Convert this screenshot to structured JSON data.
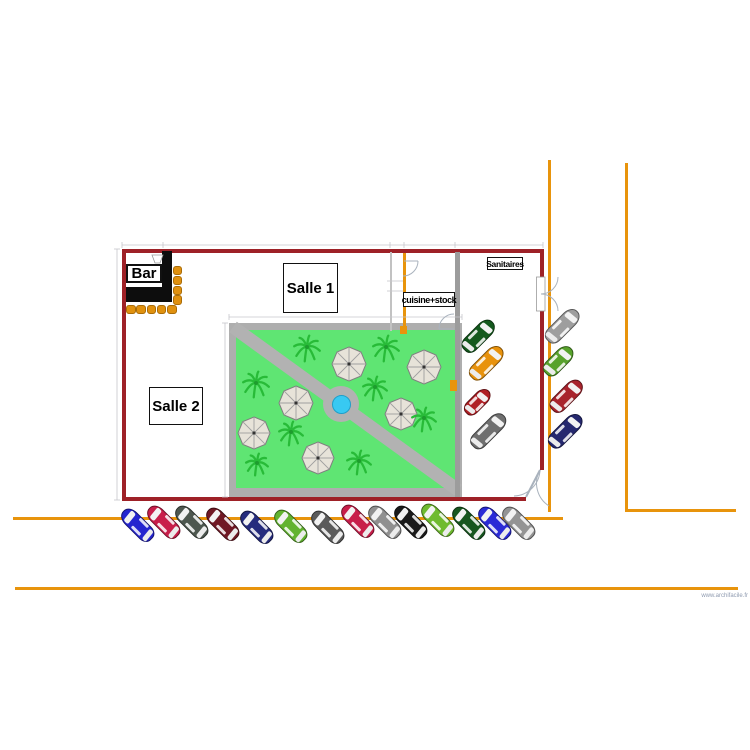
{
  "watermark": "www.archifacile.fr",
  "labels": {
    "bar": "Bar",
    "salle1": "Salle 1",
    "salle2": "Salle 2",
    "cuisine": "cuisine+stock",
    "sanitaires": "Sanitaires"
  },
  "colors": {
    "wall": "#9e2127",
    "interior_wall": "#9c9c9c",
    "thin_wall": "#c2c2c2",
    "bar": "#0d0d0d",
    "stool": "#e0910f",
    "stool_border": "#a96c08",
    "road": "#e8940c",
    "garden_frame": "#aeaeae",
    "grass": "#5fe573",
    "path": "#b2b2b2",
    "pool_rim": "#b2b2b2",
    "pool_water": "#38c9f2",
    "pool_water_edge": "#1f9fc9",
    "palm": "#28bb38",
    "palm_core": "#1e9c2e",
    "parasol": "#e7e3d9",
    "parasol_edge": "#7f7f7f",
    "parasol_line": "#9f9f9f",
    "door": "#a9b2bd",
    "dim": "#c6c6cc"
  },
  "plan": {
    "rects": [
      {
        "x": 122,
        "y": 249,
        "w": 421,
        "h": 3.5,
        "c": "wall",
        "name": "wall-top"
      },
      {
        "x": 122,
        "y": 249,
        "w": 3.5,
        "h": 251,
        "c": "wall",
        "name": "wall-left"
      },
      {
        "x": 122,
        "y": 497,
        "w": 404,
        "h": 3.5,
        "c": "wall",
        "name": "wall-bottom"
      },
      {
        "x": 540,
        "y": 249,
        "w": 3.5,
        "h": 221,
        "c": "wall",
        "name": "wall-right"
      },
      {
        "x": 455,
        "y": 252,
        "w": 5,
        "h": 245,
        "c": "interior_wall",
        "name": "wall-interior-vertical"
      },
      {
        "x": 390,
        "y": 252,
        "w": 1.5,
        "h": 79,
        "c": "thin_wall",
        "name": "wall-cuisine-left"
      },
      {
        "x": 162,
        "y": 251,
        "w": 10,
        "h": 51,
        "c": "bar",
        "name": "bar-counter-vertical"
      },
      {
        "x": 126,
        "y": 287,
        "w": 46,
        "h": 15,
        "c": "bar",
        "name": "bar-counter-horizontal"
      }
    ]
  },
  "roads": [
    {
      "x": 548,
      "y": 160,
      "w": 3,
      "h": 352,
      "name": "road-vertical-1"
    },
    {
      "x": 625,
      "y": 163,
      "w": 3,
      "h": 348,
      "name": "road-vertical-2"
    },
    {
      "x": 625,
      "y": 509,
      "w": 111,
      "h": 3,
      "name": "road-horizontal-right"
    },
    {
      "x": 13,
      "y": 517,
      "w": 550,
      "h": 3,
      "name": "road-horizontal-parking"
    },
    {
      "x": 15,
      "y": 587,
      "w": 723,
      "h": 3,
      "name": "road-horizontal-bottom"
    },
    {
      "x": 400,
      "y": 326,
      "w": 7,
      "h": 8,
      "name": "road-marker-1"
    },
    {
      "x": 450,
      "y": 380,
      "w": 7,
      "h": 11,
      "name": "road-marker-2"
    },
    {
      "x": 403,
      "y": 253,
      "w": 3,
      "h": 78,
      "name": "road-cuisine-line"
    }
  ],
  "garden": {
    "x": 229,
    "y": 323,
    "w": 233,
    "h": 174,
    "inner": {
      "x": 236,
      "y": 330,
      "w": 219,
      "h": 158
    },
    "path": {
      "x1": 233,
      "y1": 327,
      "x2": 458,
      "y2": 490,
      "width": 13
    },
    "pool": {
      "cx": 341,
      "cy": 404,
      "r_outer": 18,
      "r_inner": 9.5
    },
    "parasols": [
      {
        "cx": 349,
        "cy": 364,
        "r": 17
      },
      {
        "cx": 424,
        "cy": 367,
        "r": 17
      },
      {
        "cx": 296,
        "cy": 403,
        "r": 17
      },
      {
        "cx": 401,
        "cy": 414,
        "r": 16
      },
      {
        "cx": 254,
        "cy": 433,
        "r": 16
      },
      {
        "cx": 318,
        "cy": 458,
        "r": 16
      }
    ],
    "palms": [
      {
        "cx": 307,
        "cy": 347,
        "r": 13
      },
      {
        "cx": 386,
        "cy": 347,
        "r": 13
      },
      {
        "cx": 256,
        "cy": 383,
        "r": 13
      },
      {
        "cx": 375,
        "cy": 387,
        "r": 12
      },
      {
        "cx": 424,
        "cy": 418,
        "r": 12
      },
      {
        "cx": 291,
        "cy": 432,
        "r": 12
      },
      {
        "cx": 257,
        "cy": 463,
        "r": 11
      },
      {
        "cx": 359,
        "cy": 461,
        "r": 12
      }
    ]
  },
  "bar_area": {
    "stool_size": 9.5,
    "stools": [
      {
        "x": 172.5,
        "y": 265.5
      },
      {
        "x": 172.5,
        "y": 275.5
      },
      {
        "x": 172.5,
        "y": 285.5
      },
      {
        "x": 172.5,
        "y": 295
      },
      {
        "x": 126,
        "y": 304.5
      },
      {
        "x": 136.3,
        "y": 304.5
      },
      {
        "x": 146.6,
        "y": 304.5
      },
      {
        "x": 156.9,
        "y": 304.5
      },
      {
        "x": 167.2,
        "y": 304.5
      }
    ]
  },
  "cars": [
    {
      "x": 137,
      "y": 525,
      "rot": -45,
      "c": "#2525cf"
    },
    {
      "x": 163,
      "y": 522,
      "rot": -45,
      "c": "#c81e4a"
    },
    {
      "x": 191,
      "y": 522,
      "rot": -45,
      "c": "#4d574f"
    },
    {
      "x": 222,
      "y": 524,
      "rot": -45,
      "c": "#701824"
    },
    {
      "x": 256,
      "y": 527,
      "rot": -45,
      "c": "#252b7d"
    },
    {
      "x": 290,
      "y": 526,
      "rot": -45,
      "c": "#62b32f"
    },
    {
      "x": 327,
      "y": 527,
      "rot": -45,
      "c": "#5a5a5a"
    },
    {
      "x": 357,
      "y": 521,
      "rot": -45,
      "c": "#c81e4a"
    },
    {
      "x": 384,
      "y": 522,
      "rot": -45,
      "c": "#909090"
    },
    {
      "x": 410,
      "y": 522,
      "rot": -45,
      "c": "#1a1a1a"
    },
    {
      "x": 437,
      "y": 520,
      "rot": -45,
      "c": "#6fbb2f"
    },
    {
      "x": 468,
      "y": 523,
      "rot": -45,
      "c": "#17561f"
    },
    {
      "x": 494,
      "y": 523,
      "rot": -45,
      "c": "#2b2bd6"
    },
    {
      "x": 518,
      "y": 523,
      "rot": -45,
      "c": "#949494"
    },
    {
      "x": 478,
      "y": 336,
      "rot": 45,
      "c": "#14591d",
      "l": 40
    },
    {
      "x": 486,
      "y": 363,
      "rot": 45,
      "c": "#e8920c",
      "l": 42
    },
    {
      "x": 477,
      "y": 402,
      "rot": 45,
      "c": "#b02025",
      "l": 32,
      "w": 15
    },
    {
      "x": 488,
      "y": 431,
      "rot": 45,
      "c": "#6f6f6f",
      "l": 44
    },
    {
      "x": 562,
      "y": 326,
      "rot": 45,
      "c": "#9e9e9e",
      "l": 42
    },
    {
      "x": 558,
      "y": 361,
      "rot": 45,
      "c": "#58a22c",
      "l": 36
    },
    {
      "x": 566,
      "y": 396,
      "rot": 45,
      "c": "#a8242d",
      "l": 40
    },
    {
      "x": 565,
      "y": 431,
      "rot": 45,
      "c": "#25286f",
      "l": 42
    }
  ],
  "overlay": {
    "door_rects": [
      {
        "x": 536.5,
        "y": 277,
        "w": 8.5,
        "h": 34
      }
    ],
    "door_paths": [
      {
        "d": "M 404 261 L 418 261",
        "w": 1
      },
      {
        "d": "M 418 261 A 15 15 0 0 1 403 276",
        "w": 1
      },
      {
        "d": "M 439 329 L 454 329",
        "w": 1
      },
      {
        "d": "M 439 329 A 15 15 0 0 1 454 314",
        "w": 1
      },
      {
        "d": "M 541 294 A 17 17 0 0 0 558 277",
        "w": 1
      },
      {
        "d": "M 541 294 A 17 17 0 0 1 558 311",
        "w": 1
      },
      {
        "d": "M 540 470 L 526 497",
        "w": 2
      },
      {
        "d": "M 540 470 A 27 27 0 0 0 549 506",
        "w": 1
      },
      {
        "d": "M 540 470 A 27 27 0 0 1 514 496",
        "w": 1
      }
    ],
    "tap_polygon": "152,255 163,255 160,263 155,263",
    "dim_segments": [
      {
        "d": "M 122 245 L 543 245"
      },
      {
        "d": "M 122 242 L 122 248"
      },
      {
        "d": "M 163 242 L 163 248"
      },
      {
        "d": "M 390 242 L 390 248"
      },
      {
        "d": "M 404 242 L 404 248"
      },
      {
        "d": "M 455 242 L 455 248"
      },
      {
        "d": "M 543 242 L 543 248"
      },
      {
        "d": "M 117 249 L 117 500"
      },
      {
        "d": "M 114 249 L 120 249"
      },
      {
        "d": "M 114 500 L 120 500"
      },
      {
        "d": "M 225 323 L 225 497"
      },
      {
        "d": "M 222 323 L 228 323"
      },
      {
        "d": "M 222 497 L 228 497"
      },
      {
        "d": "M 229 317 L 462 317"
      },
      {
        "d": "M 229 314 L 229 320"
      },
      {
        "d": "M 462 314 L 462 320"
      },
      {
        "d": "M 387 281 L 403 281"
      },
      {
        "d": "M 387 291 L 403 291"
      }
    ]
  }
}
